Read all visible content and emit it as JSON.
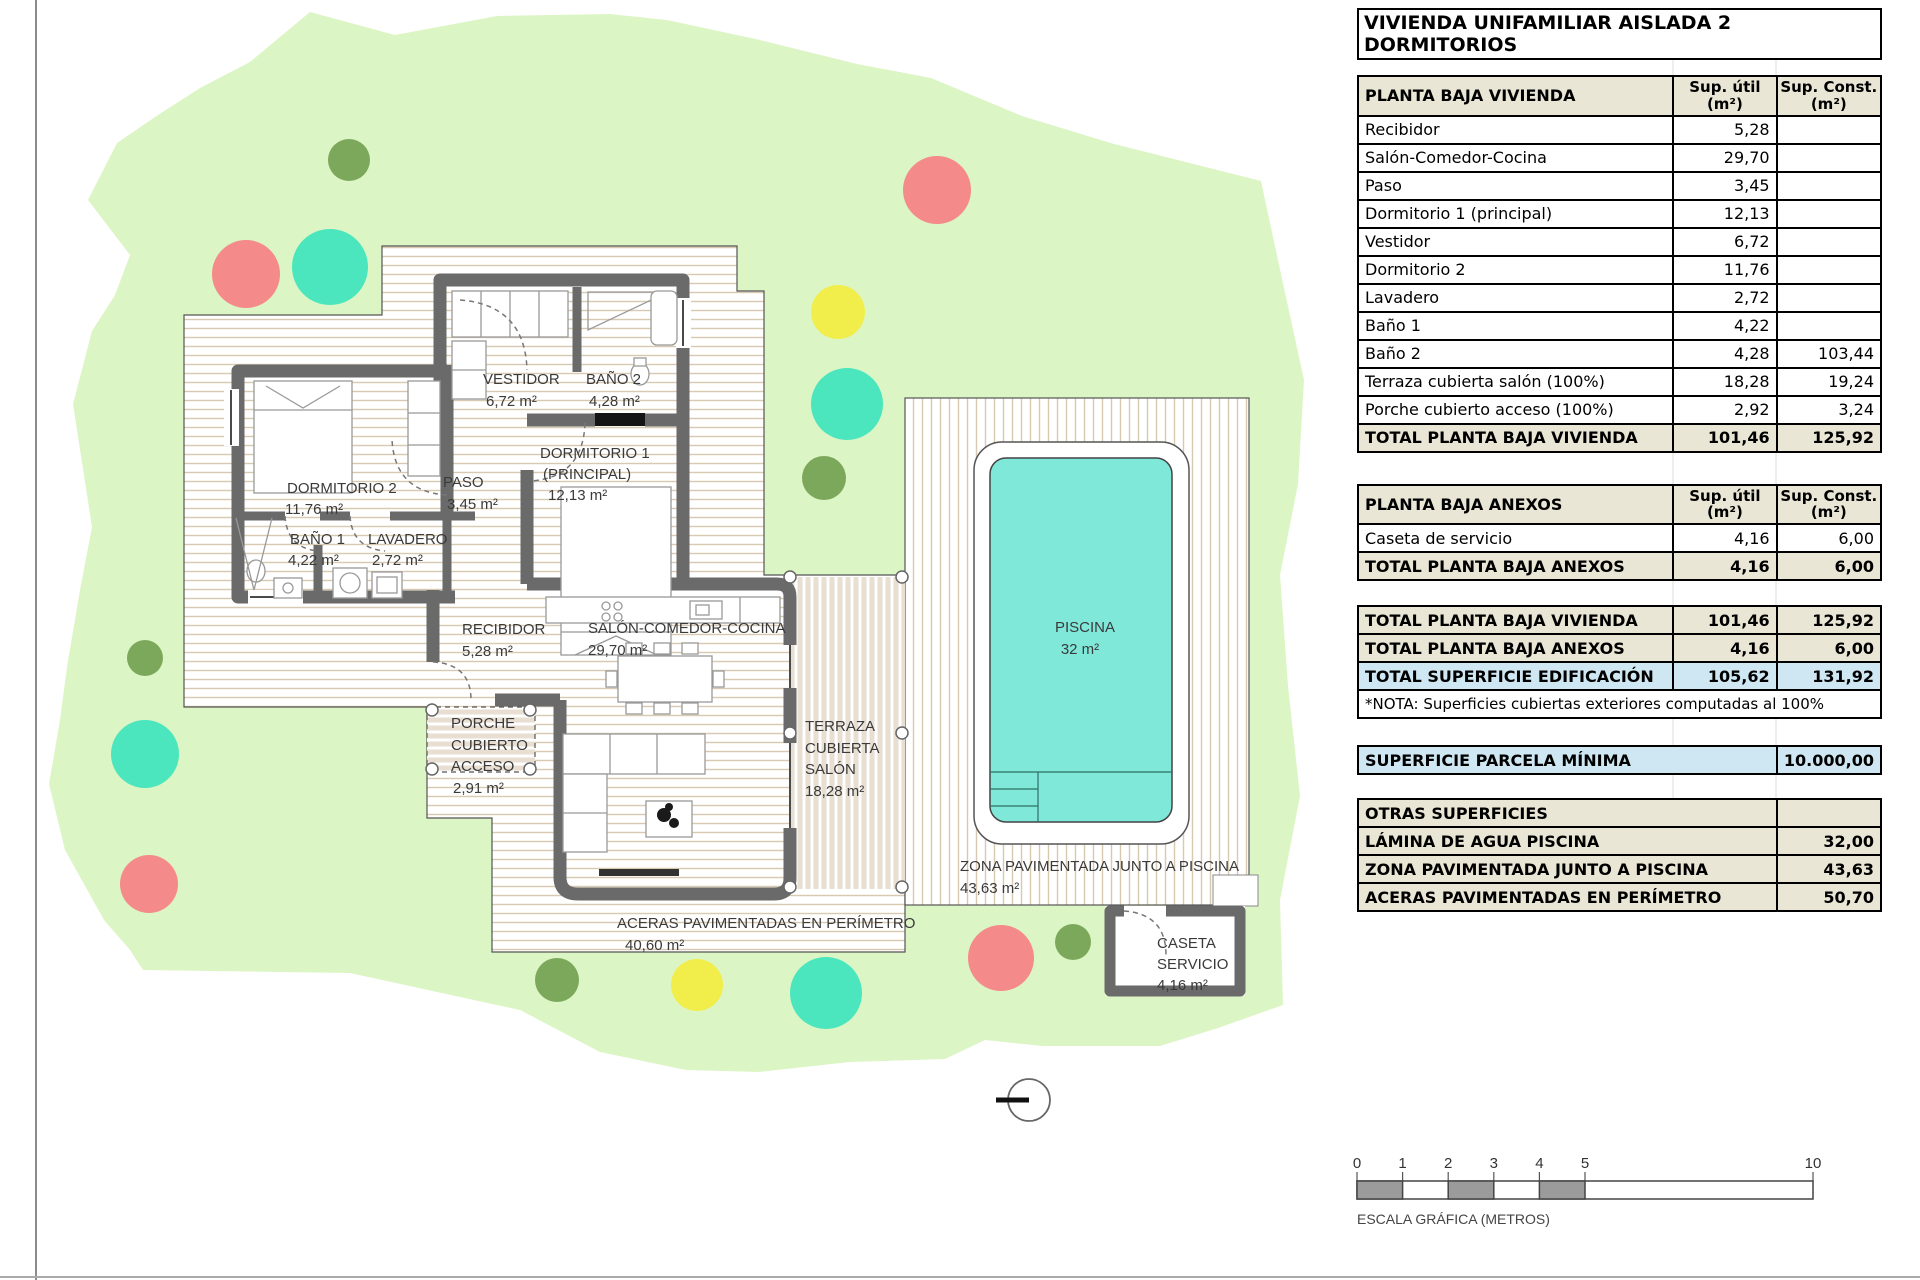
{
  "title": "VIVIENDA UNIFAMILIAR AISLADA 2 DORMITORIOS",
  "columns": {
    "util": "Sup. útil",
    "konst": "Sup. Const.",
    "unit": "(m²)"
  },
  "t1": {
    "header": "PLANTA BAJA VIVIENDA",
    "rows": [
      {
        "label": "Recibidor",
        "util": "5,28",
        "c": ""
      },
      {
        "label": "Salón-Comedor-Cocina",
        "util": "29,70",
        "c": ""
      },
      {
        "label": "Paso",
        "util": "3,45",
        "c": ""
      },
      {
        "label": "Dormitorio 1 (principal)",
        "util": "12,13",
        "c": ""
      },
      {
        "label": "Vestidor",
        "util": "6,72",
        "c": ""
      },
      {
        "label": "Dormitorio 2",
        "util": "11,76",
        "c": ""
      },
      {
        "label": "Lavadero",
        "util": "2,72",
        "c": ""
      },
      {
        "label": "Baño 1",
        "util": "4,22",
        "c": ""
      },
      {
        "label": "Baño 2",
        "util": "4,28",
        "c": "103,44"
      },
      {
        "label": "Terraza cubierta salón (100%)",
        "util": "18,28",
        "c": "19,24"
      },
      {
        "label": "Porche cubierto acceso (100%)",
        "util": "2,92",
        "c": "3,24"
      }
    ],
    "total": {
      "label": "TOTAL PLANTA BAJA VIVIENDA",
      "util": "101,46",
      "c": "125,92"
    }
  },
  "t2": {
    "header": "PLANTA BAJA ANEXOS",
    "rows": [
      {
        "label": "Caseta de servicio",
        "util": "4,16",
        "c": "6,00"
      }
    ],
    "total": {
      "label": "TOTAL PLANTA BAJA ANEXOS",
      "util": "4,16",
      "c": "6,00"
    }
  },
  "t3": {
    "rows": [
      {
        "label": "TOTAL PLANTA BAJA VIVIENDA",
        "util": "101,46",
        "c": "125,92"
      },
      {
        "label": "TOTAL PLANTA BAJA ANEXOS",
        "util": "4,16",
        "c": "6,00"
      },
      {
        "label": "TOTAL SUPERFICIE EDIFICACIÓN",
        "util": "105,62",
        "c": "131,92"
      }
    ],
    "nota": "*NOTA: Superficies cubiertas exteriores computadas al 100%"
  },
  "parcela": {
    "label": "SUPERFICIE PARCELA MÍNIMA",
    "value": "10.000,00"
  },
  "otras": {
    "header": "OTRAS SUPERFICIES",
    "rows": [
      {
        "label": "LÁMINA DE AGUA PISCINA",
        "value": "32,00"
      },
      {
        "label": "ZONA PAVIMENTADA JUNTO A PISCINA",
        "value": "43,63"
      },
      {
        "label": "ACERAS PAVIMENTADAS EN PERÍMETRO",
        "value": "50,70"
      }
    ]
  },
  "plan": {
    "dorm2": {
      "name": "DORMITORIO 2",
      "area": "11,76 m²"
    },
    "bano1": {
      "name": "BAÑO 1",
      "area": "4,22 m²"
    },
    "lavadero": {
      "name": "LAVADERO",
      "area": "2,72 m²"
    },
    "paso": {
      "name": "PASO",
      "area": "3,45 m²"
    },
    "vestidor": {
      "name": "VESTIDOR",
      "area": "6,72 m²"
    },
    "bano2": {
      "name": "BAÑO 2",
      "area": "4,28 m²"
    },
    "dorm1": {
      "name": "DORMITORIO 1",
      "name2": "(PRINCIPAL)",
      "area": "12,13 m²"
    },
    "recibidor": {
      "name": "RECIBIDOR",
      "area": "5,28 m²"
    },
    "salon": {
      "name": "SALÓN-COMEDOR-COCINA",
      "area": "29,70 m²"
    },
    "porche": {
      "l1": "PORCHE",
      "l2": "CUBIERTO",
      "l3": "ACCESO",
      "area": "2,91 m²"
    },
    "terraza": {
      "l1": "TERRAZA",
      "l2": "CUBIERTA",
      "l3": "SALÓN",
      "area": "18,28 m²"
    },
    "aceras": {
      "l1": "ACERAS PAVIMENTADAS EN PERÍMETRO",
      "area": "40,60 m²"
    },
    "zona": {
      "l1": "ZONA PAVIMENTADA JUNTO A PISCINA",
      "area": "43,63 m²"
    },
    "piscina": {
      "name": "PISCINA",
      "area": "32 m²"
    },
    "caseta": {
      "l1": "CASETA",
      "l2": "SERVICIO",
      "area": "4,16 m²"
    }
  },
  "scalebar": {
    "ticks": [
      "0",
      "1",
      "2",
      "3",
      "4",
      "5",
      "10"
    ],
    "label": "ESCALA GRÁFICA (METROS)"
  },
  "colors": {
    "plot_green": "#DCF5C4",
    "tree_red": "#F58A8A",
    "tree_turquoise": "#4BE6BD",
    "tree_yellow": "#F1EE4B",
    "tree_green": "#7CA85C",
    "pool_water": "#7FE8D9",
    "table_tan": "#E9E6D5",
    "table_blue": "#CFE7F2",
    "wall_gray": "#6A6A6A"
  }
}
